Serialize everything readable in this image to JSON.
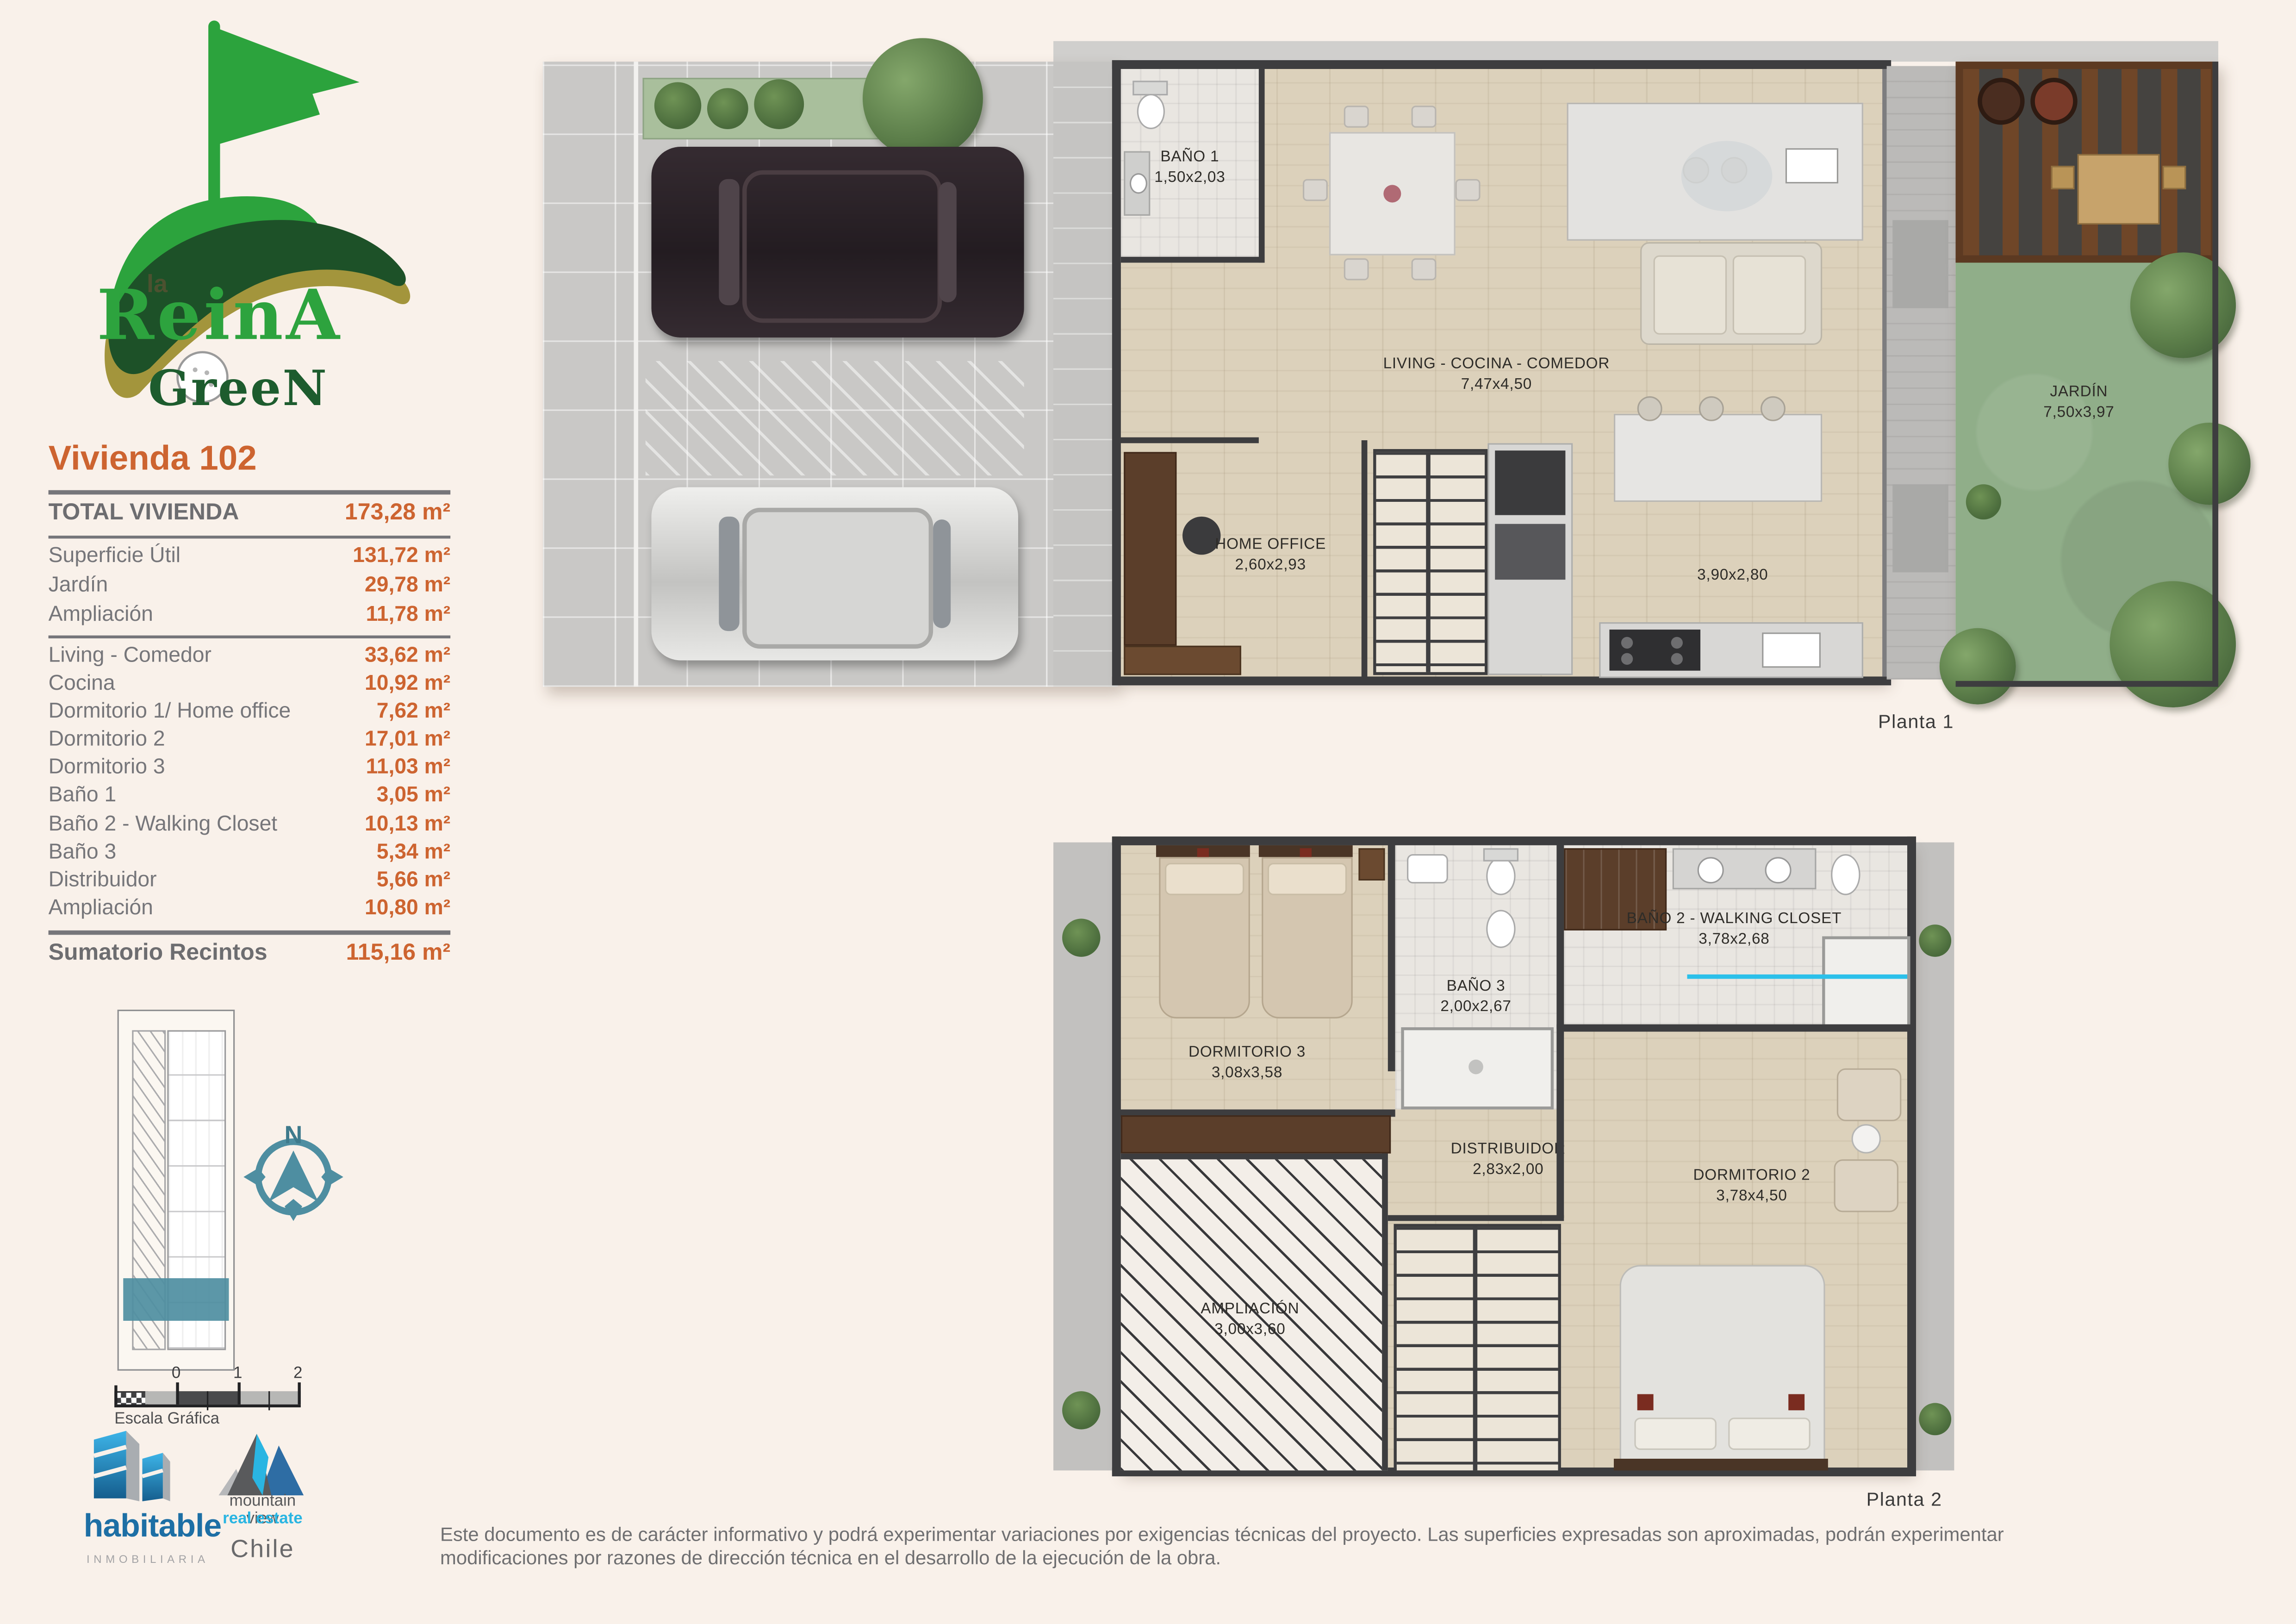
{
  "brand": {
    "name_prefix": "la",
    "name_main": "ReinA",
    "name_sub": "GreeN"
  },
  "panel": {
    "title": "Vivienda 102",
    "total": {
      "label": "TOTAL VIVIENDA",
      "value": "173,28 m²"
    },
    "summary": [
      {
        "label": "Superficie Útil",
        "value": "131,72 m²"
      },
      {
        "label": "Jardín",
        "value": "29,78 m²"
      },
      {
        "label": "Ampliación",
        "value": "11,78 m²"
      }
    ],
    "rooms": [
      {
        "label": "Living - Comedor",
        "value": "33,62 m²"
      },
      {
        "label": "Cocina",
        "value": "10,92 m²"
      },
      {
        "label": "Dormitorio 1/ Home office",
        "value": "7,62 m²"
      },
      {
        "label": "Dormitorio 2",
        "value": "17,01 m²"
      },
      {
        "label": "Dormitorio 3",
        "value": "11,03 m²"
      },
      {
        "label": "Baño 1",
        "value": "3,05 m²"
      },
      {
        "label": "Baño 2 - Walking Closet",
        "value": "10,13 m²"
      },
      {
        "label": "Baño 3",
        "value": "5,34 m²"
      },
      {
        "label": "Distribuidor",
        "value": "5,66 m²"
      },
      {
        "label": "Ampliación",
        "value": "10,80 m²"
      }
    ],
    "sum": {
      "label": "Sumatorio Recintos",
      "value": "115,16 m²"
    }
  },
  "compass": {
    "north_label": "N"
  },
  "scale_bar": {
    "ticks": [
      "0",
      "1",
      "2"
    ],
    "label": "Escala Gráfica"
  },
  "logos": {
    "habitable": {
      "name": "habitable",
      "tagline": "INMOBILIARIA"
    },
    "mountain_view": {
      "line1": "mountain view",
      "line2": "real estate",
      "country": "Chile"
    }
  },
  "planta1": {
    "caption": "Planta 1",
    "labels": {
      "bano1": {
        "name": "BAÑO 1",
        "dims": "1,50x2,03"
      },
      "living": {
        "name": "LIVING - COCINA - COMEDOR",
        "dims": "7,47x4,50"
      },
      "home_office": {
        "name": "HOME OFFICE",
        "dims": "2,60x2,93"
      },
      "cocina": {
        "dims": "3,90x2,80"
      },
      "jardin": {
        "name": "JARDÍN",
        "dims": "7,50x3,97"
      }
    }
  },
  "planta2": {
    "caption": "Planta 2",
    "labels": {
      "dormitorio3": {
        "name": "DORMITORIO 3",
        "dims": "3,08x3,58"
      },
      "bano3": {
        "name": "BAÑO 3",
        "dims": "2,00x2,67"
      },
      "bano2": {
        "name": "BAÑO 2 - WALKING CLOSET",
        "dims": "3,78x2,68"
      },
      "distribuidor": {
        "name": "DISTRIBUIDOR",
        "dims": "2,83x2,00"
      },
      "dormitorio2": {
        "name": "DORMITORIO 2",
        "dims": "3,78x4,50"
      },
      "ampliacion": {
        "name": "AMPLIACIÓN",
        "dims": "3,00x3,60"
      }
    }
  },
  "footer": {
    "disclaimer": "Este documento es de carácter informativo y podrá experimentar variaciones por exigencias técnicas del proyecto. Las superficies expresadas son aproximadas, podrán experimentar modificaciones por razones de dirección técnica en el desarrollo de la ejecución de la obra."
  },
  "colors": {
    "accent_orange": "#cd6430",
    "text_gray": "#76767a",
    "brand_green_light": "#2ca33d",
    "brand_green_dark": "#1d5128",
    "brand_gold": "#a3953c",
    "site_highlight_teal": "#4e8ea1",
    "habitable_blue": "#1d6fa5",
    "real_estate_cyan": "#2ab5e2",
    "wall_dark": "#3d3d3f",
    "wood_floor": "#dcd1bb",
    "garden_green": "#90ae89"
  }
}
